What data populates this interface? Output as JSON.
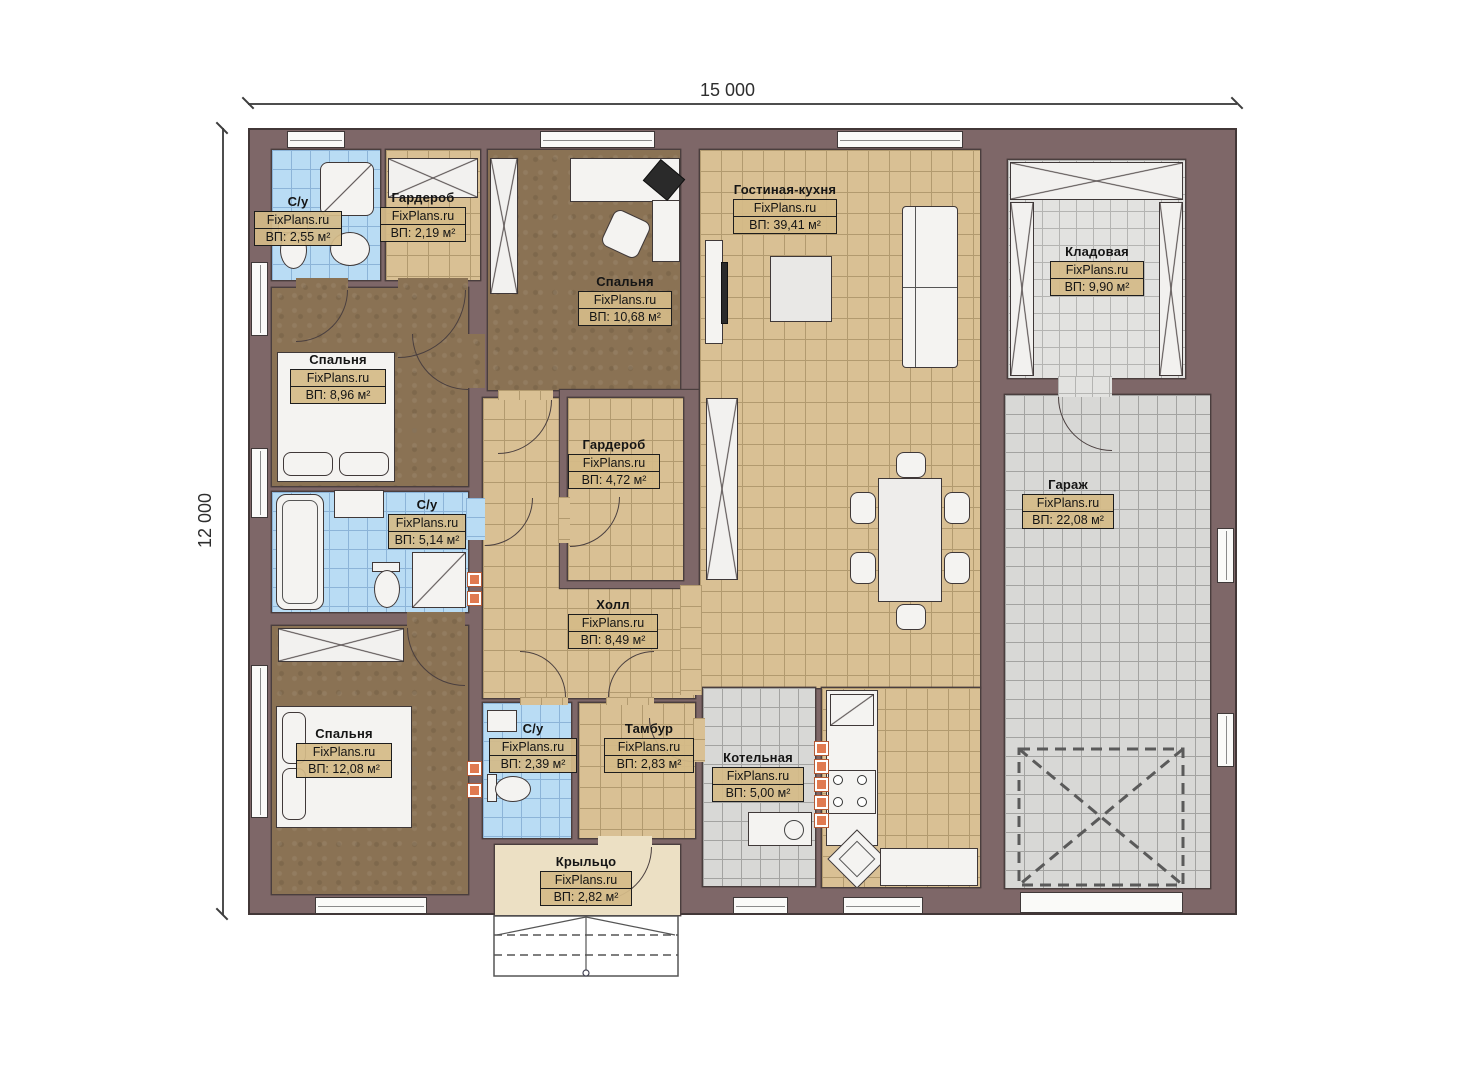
{
  "plan": {
    "watermark": "FixPlans.ru",
    "width_label": "15 000",
    "height_label": "12 000"
  },
  "rooms": [
    {
      "name": "С/у",
      "area": "ВП: 2,55 м²"
    },
    {
      "name": "Гардероб",
      "area": "ВП: 2,19 м²"
    },
    {
      "name": "Спальня",
      "area": "ВП: 10,68 м²"
    },
    {
      "name": "Гостиная-кухня",
      "area": "ВП: 39,41 м²"
    },
    {
      "name": "Кладовая",
      "area": "ВП: 9,90 м²"
    },
    {
      "name": "Спальня",
      "area": "ВП: 8,96 м²"
    },
    {
      "name": "Гардероб",
      "area": "ВП: 4,72 м²"
    },
    {
      "name": "Гараж",
      "area": "ВП: 22,08 м²"
    },
    {
      "name": "С/у",
      "area": "ВП: 5,14 м²"
    },
    {
      "name": "Холл",
      "area": "ВП: 8,49 м²"
    },
    {
      "name": "Спальня",
      "area": "ВП: 12,08 м²"
    },
    {
      "name": "С/у",
      "area": "ВП: 2,39 м²"
    },
    {
      "name": "Тамбур",
      "area": "ВП: 2,83 м²"
    },
    {
      "name": "Котельная",
      "area": "ВП: 5,00 м²"
    },
    {
      "name": "Крыльцо",
      "area": "ВП: 2,82 м²"
    }
  ]
}
